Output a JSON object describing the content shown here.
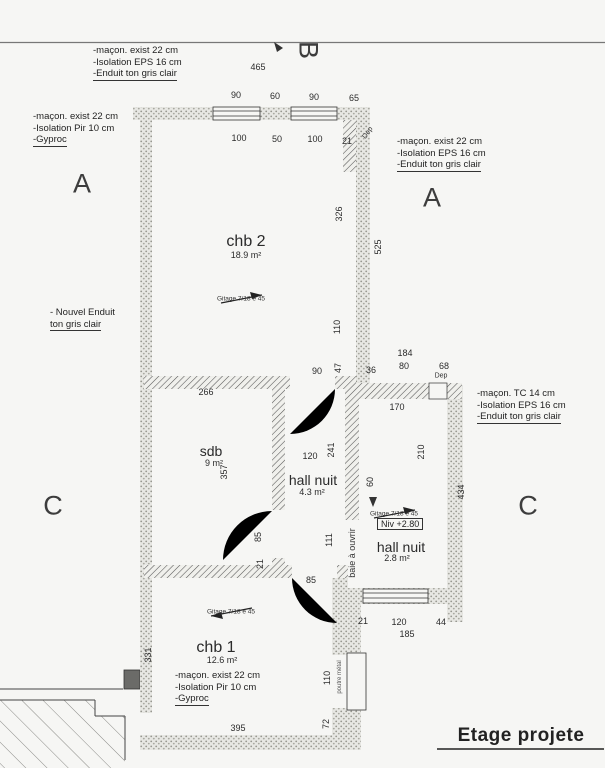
{
  "page": {
    "title": "Etage projete"
  },
  "rooms": {
    "chb2": {
      "name": "chb 2",
      "area": "18.9 m²"
    },
    "sdb": {
      "name": "sdb",
      "area": "9 m²"
    },
    "hall1": {
      "name": "hall nuit",
      "area": "4.3 m²"
    },
    "hall2": {
      "name": "hall nuit",
      "area": "2.8 m²"
    },
    "chb1": {
      "name": "chb 1",
      "area": "12.6 m²"
    }
  },
  "annotations": {
    "a1": {
      "l1": "-maçon. exist 22 cm",
      "l2": "-Isolation EPS 16 cm",
      "l3": "-Enduit ton gris clair"
    },
    "a2": {
      "l1": "-maçon. exist 22 cm",
      "l2": "-Isolation Pir 10 cm",
      "l3": "-Gyproc"
    },
    "a3": {
      "l1": "-maçon. exist 22 cm",
      "l2": "-Isolation EPS 16 cm",
      "l3": "-Enduit ton gris clair"
    },
    "a4": {
      "l1": "- Nouvel Enduit",
      "l2": "ton gris clair"
    },
    "a5": {
      "l1": "-maçon. TC 14 cm",
      "l2": "-Isolation EPS 16 cm",
      "l3": "-Enduit ton gris clair"
    },
    "a6": {
      "l1": "-maçon. exist 22 cm",
      "l2": "-Isolation Pir 10 cm",
      "l3": "-Gyproc"
    }
  },
  "labels": {
    "gitage": "Gitage 7/18 e 45",
    "niveau": "Niv +2.80",
    "baie": "baie à ouvrir",
    "poutre": "poutre métal",
    "dep": "Dep"
  },
  "markers": {
    "a": "A",
    "b": "B",
    "c": "C"
  },
  "dims": [
    "465",
    "90",
    "60",
    "90",
    "65",
    "100",
    "50",
    "100",
    "21",
    "326",
    "525",
    "110",
    "47",
    "90",
    "36",
    "184",
    "80",
    "68",
    "170",
    "266",
    "357",
    "120",
    "241",
    "111",
    "85",
    "21",
    "210",
    "60",
    "434",
    "85",
    "21",
    "120",
    "44",
    "185",
    "331",
    "110",
    "72",
    "395"
  ]
}
